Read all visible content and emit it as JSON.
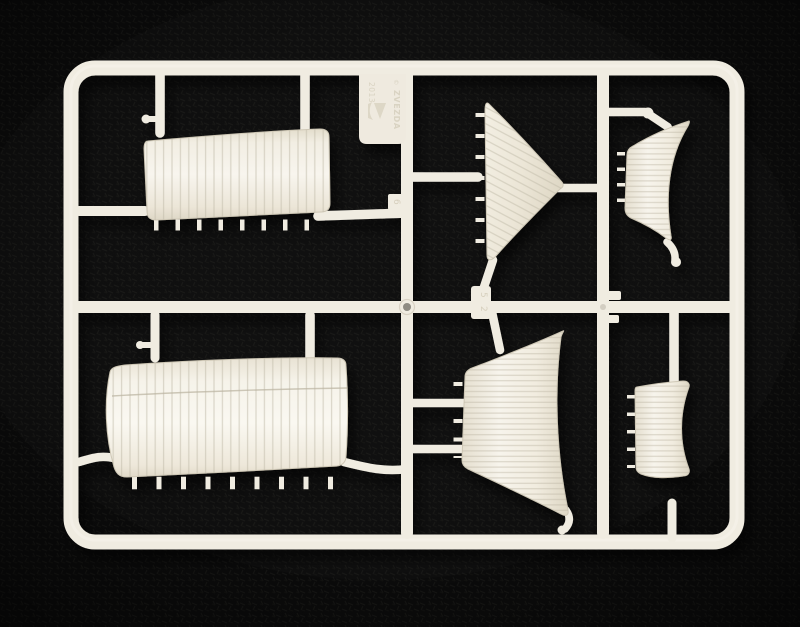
{
  "colors": {
    "background": "#0b0b0b",
    "plastic": "#f0ece1",
    "plastic_highlight": "#fbf9f3",
    "plastic_shadow": "#d7d0c0",
    "seam": "#bdb5a2",
    "pin_mark": "#8f8c83"
  },
  "sprue": {
    "maker_tag": {
      "year": "2013",
      "brand": "ZVEZDA",
      "copyright": "©",
      "logo": "zvezda-sailing-ship-logo"
    },
    "part_number_tabs": [
      {
        "label": "5"
      },
      {
        "label": "2"
      },
      {
        "label": "6"
      }
    ],
    "parts": [
      {
        "name": "large-square-sail-upper-left"
      },
      {
        "name": "large-square-sail-lower-left"
      },
      {
        "name": "triangular-jib-sail"
      },
      {
        "name": "curved-square-sail-upper-right"
      },
      {
        "name": "large-curved-sail-lower-middle"
      },
      {
        "name": "small-square-sail-lower-right"
      }
    ]
  }
}
